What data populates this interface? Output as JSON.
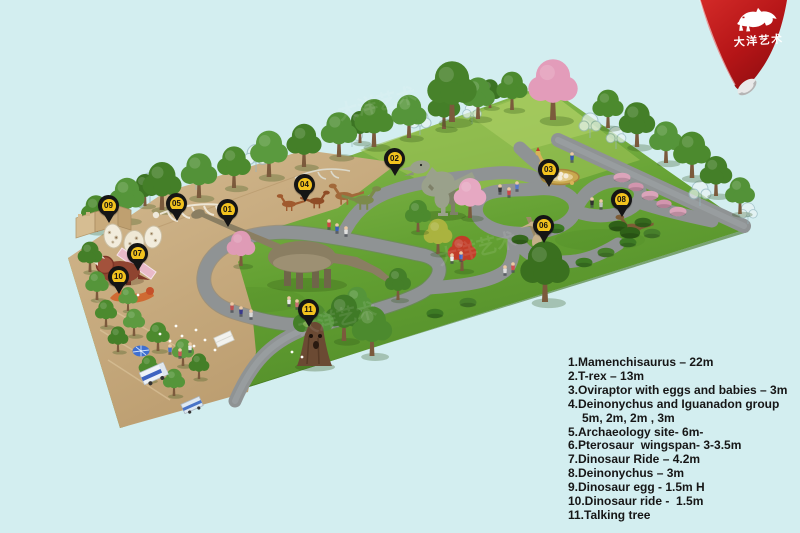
{
  "meta": {
    "title": "Dinosaur park site plan render"
  },
  "canvas": {
    "background": "#d3eef0"
  },
  "logo": {
    "brand": "大洋艺术",
    "icon": "trex-silhouette-icon",
    "ribbon_color": "#c0181b"
  },
  "watermark": {
    "text": "大洋艺术"
  },
  "pins": [
    {
      "num": "01",
      "attraction": "Mamenchisaurus"
    },
    {
      "num": "02",
      "attraction": "T-rex"
    },
    {
      "num": "03",
      "attraction": "Oviraptor with eggs and babies"
    },
    {
      "num": "04",
      "attraction": "Deinonychus and Iguanadon group"
    },
    {
      "num": "05",
      "attraction": "Archaeology site"
    },
    {
      "num": "06",
      "attraction": "Pterosaur"
    },
    {
      "num": "07",
      "attraction": "Dinosaur Ride"
    },
    {
      "num": "08",
      "attraction": "Deinonychus"
    },
    {
      "num": "09",
      "attraction": "Dinosaur egg"
    },
    {
      "num": "10",
      "attraction": "Dinosaur ride"
    },
    {
      "num": "11",
      "attraction": "Talking tree"
    }
  ],
  "legend": {
    "items": [
      "1.Mamenchisaurus – 22m",
      "2.T-rex – 13m",
      "3.Oviraptor with eggs and babies – 3m",
      "4.Deinonychus and Iguanadon group",
      "5m, 2m, 2m , 3m",
      "5.Archaeology site- 6m-",
      "6.Pterosaur  wingspan- 3-3.5m",
      "7.Dinosaur Ride – 4.2m",
      "8.Deinonychus – 3m",
      "9.Dinosaur egg - 1.5m H",
      "10.Dinosaur ride -  1.5m",
      "11.Talking tree"
    ]
  },
  "colors": {
    "pin": "#151515",
    "pin_badge": "#f2c21e",
    "grass": "#68a233",
    "dirt": "#c9ad82",
    "path": "#8f9394",
    "legend_text": "#161616"
  }
}
